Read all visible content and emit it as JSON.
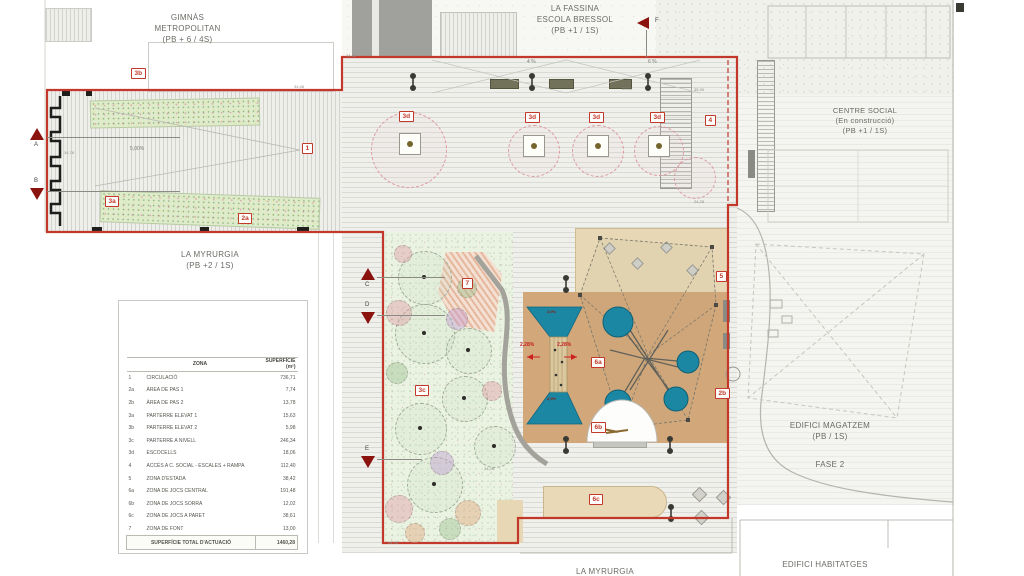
{
  "labels": {
    "gimnas": {
      "line1": "GIMNÀS",
      "line2": "METROPOLITAN",
      "line3": "(PB + 6 / 4S)"
    },
    "fassina": {
      "line1": "LA FASSINA",
      "line2": "ESCOLA BRESSOL",
      "line3": "(PB +1 / 1S)"
    },
    "centre_social": {
      "line1": "CENTRE SOCIAL",
      "line2": "(En construcció)",
      "line3": "(PB +1 / 1S)"
    },
    "myrurgia_left": {
      "line1": "LA MYRURGIA",
      "line2": "(PB +2 / 1S)"
    },
    "magatzem": {
      "line1": "EDIFICI MAGATZEM",
      "line2": "(PB / 1S)"
    },
    "fase2": "FASE 2",
    "habitatges": "EDIFICI HABITATGES",
    "myrurgia_bottom": "LA MYRURGIA"
  },
  "legend": {
    "col_zone": "ZONA",
    "col_superficie": "SUPERFÍCIE (m²)",
    "rows": [
      [
        "1",
        "CIRCULACIÓ",
        "736,71"
      ],
      [
        "2a",
        "ÀREA DE PAS 1",
        "7,74"
      ],
      [
        "2b",
        "ÀREA DE PAS 2",
        "13,78"
      ],
      [
        "3a",
        "PARTERRE ELEVAT 1",
        "15,63"
      ],
      [
        "3b",
        "PARTERRE ELEVAT 2",
        "5,98"
      ],
      [
        "3c",
        "PARTERRE A NIVELL",
        "246,34"
      ],
      [
        "3d",
        "ESCOCELLS",
        "18,06"
      ],
      [
        "4",
        "ACCÉS A C. SOCIAL - ESCALES + RAMPA",
        "112,40"
      ],
      [
        "5",
        "ZONA D'ESTADA",
        "38,42"
      ],
      [
        "6a",
        "ZONA DE JOCS CENTRAL",
        "191,48"
      ],
      [
        "6b",
        "ZONA DE JOCS SORRA",
        "12,02"
      ],
      [
        "6c",
        "ZONA DE JOCS A PARET",
        "38,61"
      ],
      [
        "7",
        "ZONA DE FONT",
        "13,00"
      ]
    ],
    "total_label": "SUPERFÍCIE TOTAL D'ACTUACIÓ",
    "total_value": "1460,28"
  },
  "markers": [
    [
      "3b",
      131,
      68
    ],
    [
      "3a",
      105,
      196
    ],
    [
      "2a",
      238,
      213
    ],
    [
      "1",
      302,
      143
    ],
    [
      "3d",
      399,
      111
    ],
    [
      "3d",
      525,
      112
    ],
    [
      "3d",
      589,
      112
    ],
    [
      "3d",
      650,
      112
    ],
    [
      "4",
      705,
      115
    ],
    [
      "5",
      716,
      271
    ],
    [
      "2b",
      715,
      388
    ],
    [
      "6a",
      591,
      357
    ],
    [
      "6b",
      591,
      422
    ],
    [
      "6c",
      589,
      494
    ],
    [
      "7",
      462,
      278
    ],
    [
      "3c",
      415,
      385
    ]
  ],
  "section_arrows": [
    {
      "letter": "A",
      "dir": "up",
      "tri": [
        30,
        128
      ],
      "letter_xy": [
        34,
        142
      ],
      "line": [
        47,
        137,
        133,
        1
      ]
    },
    {
      "letter": "B",
      "dir": "down",
      "tri": [
        30,
        188
      ],
      "letter_xy": [
        34,
        178
      ],
      "line": [
        47,
        191,
        133,
        1
      ]
    },
    {
      "letter": "C",
      "dir": "up",
      "tri": [
        361,
        268
      ],
      "letter_xy": [
        365,
        282
      ],
      "line": [
        377,
        277,
        68,
        1
      ]
    },
    {
      "letter": "D",
      "dir": "down",
      "tri": [
        361,
        312
      ],
      "letter_xy": [
        365,
        302
      ],
      "line": [
        377,
        315,
        68,
        1
      ]
    },
    {
      "letter": "E",
      "dir": "down",
      "tri": [
        361,
        456
      ],
      "letter_xy": [
        365,
        446
      ],
      "line": [
        377,
        459,
        45,
        1
      ]
    },
    {
      "letter": "F",
      "dir": "left",
      "tri": [
        637,
        17
      ],
      "letter_xy": [
        655,
        18
      ],
      "line": [
        646,
        30,
        1,
        27
      ]
    }
  ],
  "dimensions": [
    {
      "t": "34,48",
      "x": 346,
      "y": 53
    },
    {
      "t": "34,48",
      "x": 294,
      "y": 84
    },
    {
      "t": "34,51",
      "x": 622,
      "y": 86
    },
    {
      "t": "35,39",
      "x": 694,
      "y": 87
    },
    {
      "t": "24,28",
      "x": 694,
      "y": 199
    },
    {
      "t": "34,28",
      "x": 388,
      "y": 540
    },
    {
      "t": "34,28",
      "x": 484,
      "y": 466
    },
    {
      "t": "34,78",
      "x": 64,
      "y": 150
    }
  ],
  "slope_labels": [
    {
      "t": "4 %",
      "x": 527,
      "y": 59,
      "c": "g"
    },
    {
      "t": "6 %",
      "x": 648,
      "y": 59,
      "c": "g"
    },
    {
      "t": "5,00%",
      "x": 130,
      "y": 146,
      "c": "g"
    },
    {
      "t": "2,28%",
      "x": 520,
      "y": 342,
      "c": "r"
    },
    {
      "t": "2,28%",
      "x": 557,
      "y": 342,
      "c": "r"
    },
    {
      "t": "2,0%",
      "x": 547,
      "y": 309,
      "c": "r2"
    },
    {
      "t": "2,0%",
      "x": 547,
      "y": 396,
      "c": "r2"
    }
  ],
  "plaza_trees": [
    [
      408,
      149,
      37
    ],
    [
      533,
      150,
      25
    ],
    [
      597,
      150,
      25
    ],
    [
      658,
      150,
      24
    ],
    [
      694,
      177,
      20
    ]
  ],
  "tree_pits": [
    [
      409,
      143
    ],
    [
      533,
      145
    ],
    [
      597,
      145
    ],
    [
      658,
      145
    ]
  ],
  "garden_trees": [
    [
      424,
      277,
      26
    ],
    [
      424,
      333,
      29
    ],
    [
      468,
      350,
      22
    ],
    [
      464,
      398,
      22
    ],
    [
      420,
      428,
      25
    ],
    [
      434,
      484,
      27
    ],
    [
      494,
      446,
      20
    ]
  ],
  "bushes": [
    [
      398,
      312,
      12,
      "pink"
    ],
    [
      456,
      318,
      10,
      "purple"
    ],
    [
      396,
      372,
      10,
      "green"
    ],
    [
      441,
      462,
      11,
      "purple"
    ],
    [
      398,
      508,
      13,
      "pink"
    ],
    [
      467,
      512,
      12,
      "orange"
    ],
    [
      491,
      390,
      9,
      "pink"
    ],
    [
      414,
      532,
      9,
      "orange"
    ],
    [
      449,
      528,
      10,
      "green"
    ],
    [
      466,
      287,
      9,
      "green"
    ],
    [
      402,
      253,
      8,
      "pink"
    ]
  ],
  "colors": {
    "boundary_red": "#c2392b",
    "marker_red": "#c2392b",
    "arrow_maroon": "#8a140d",
    "teal": "#1b87a3",
    "tan": "#d2a87a",
    "beige": "#e7d7b4",
    "olive_bench": "#72725a"
  }
}
